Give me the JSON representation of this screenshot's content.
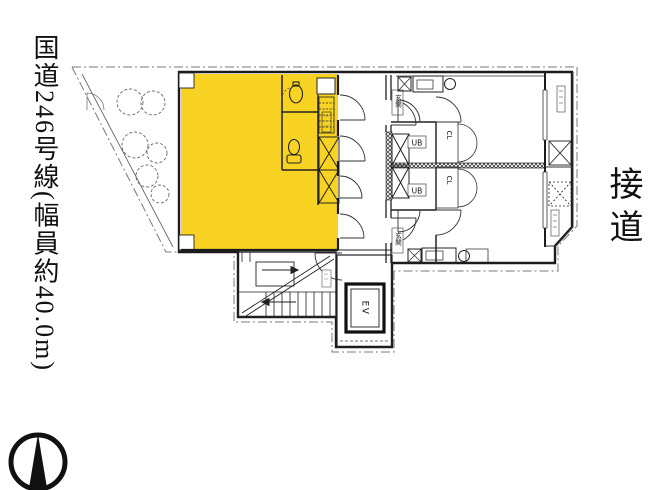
{
  "page": {
    "background": "#ffffff"
  },
  "roads": {
    "left": "国道246号線(幅員約40.0m)",
    "right": "接道"
  },
  "floorplan": {
    "highlight_color": "#f8d324",
    "labels": {
      "elevator": "EV",
      "closet": "CL",
      "unit_bath": "UB",
      "entrance": "玄関"
    }
  }
}
